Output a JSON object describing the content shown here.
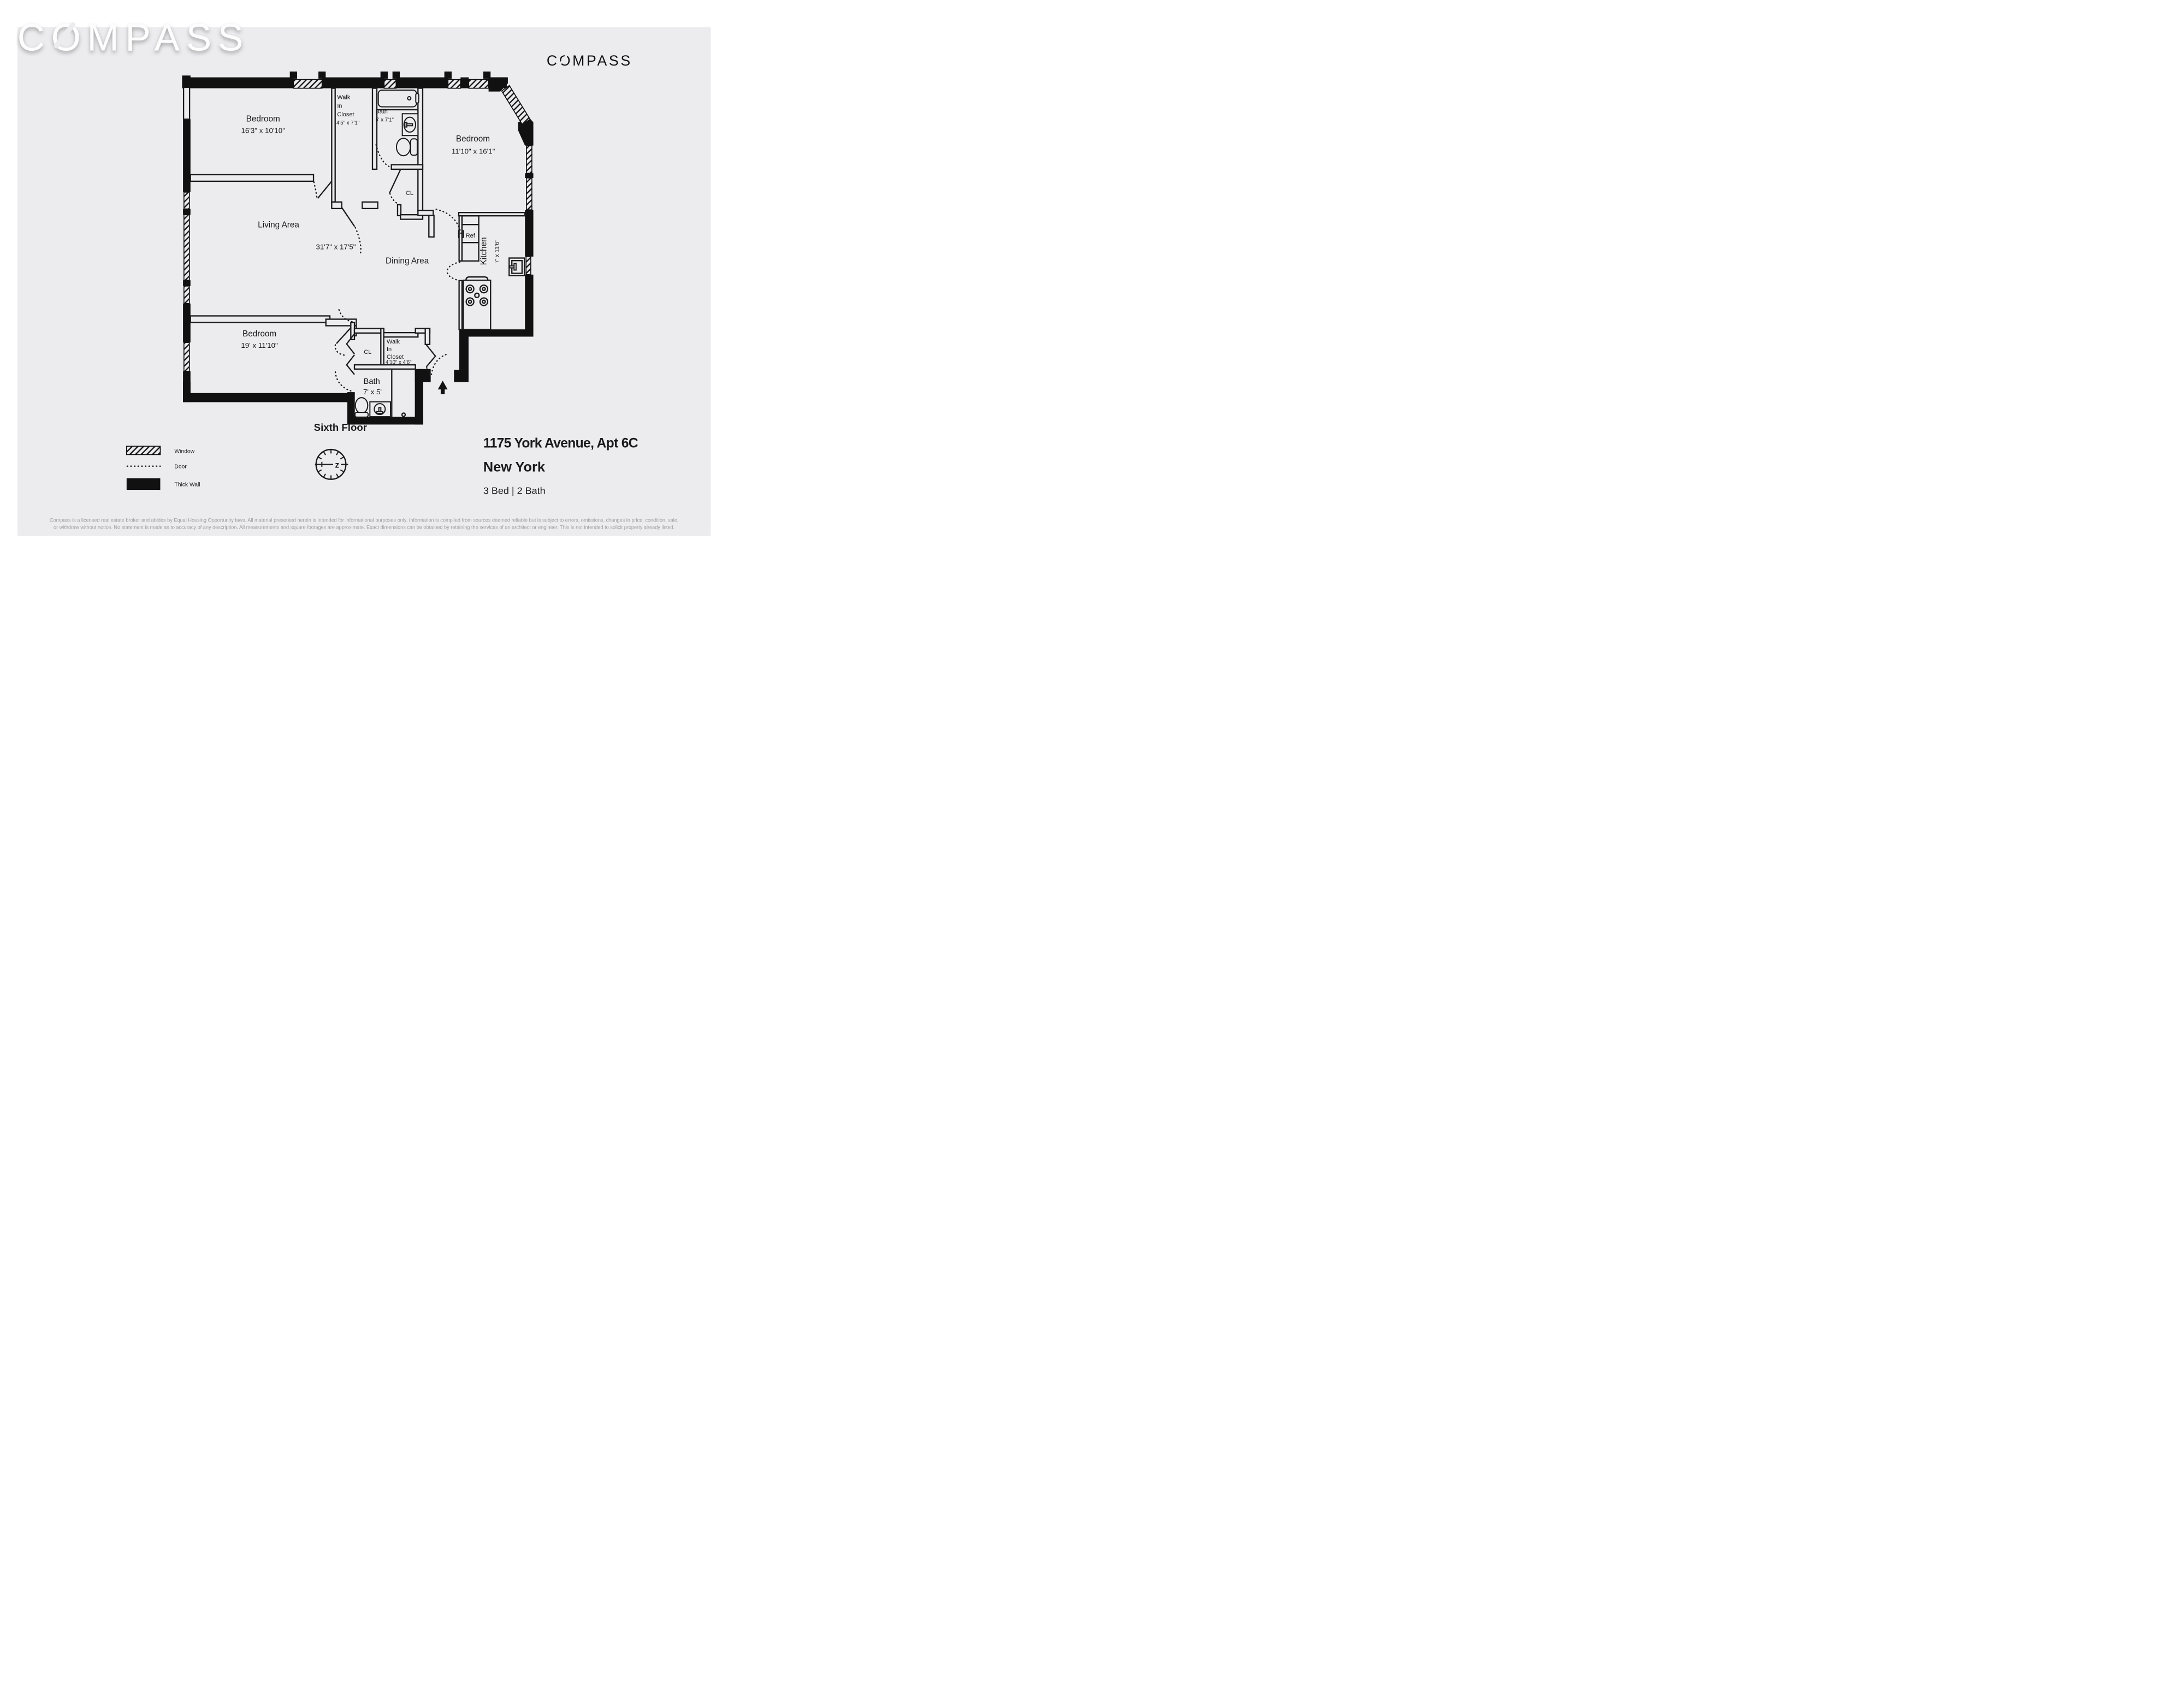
{
  "branding": {
    "watermark": "COMPASS",
    "logo": "COMPASS"
  },
  "plan": {
    "rooms": {
      "bedroom_top_left": {
        "name": "Bedroom",
        "dims": "16'3\" x 10'10\""
      },
      "walk_in_closet_top": {
        "line1": "Walk",
        "line2": "In",
        "line3": "Closet",
        "dims": "4'5\" x 7'1\""
      },
      "bath_top": {
        "name": "Bath",
        "dims": "5' x 7'1\""
      },
      "closet_top": {
        "name": "CL"
      },
      "bedroom_top_right": {
        "name": "Bedroom",
        "dims": "11'10\" x 16'1\""
      },
      "living": {
        "name": "Living Area",
        "dims": "31'7\" x 17'5\""
      },
      "dining": {
        "name": "Dining Area"
      },
      "kitchen": {
        "name": "Kitchen",
        "dims": "7' x 11'6\"",
        "fridge": "Ref"
      },
      "bedroom_bottom": {
        "name": "Bedroom",
        "dims": "19' x 11'10\""
      },
      "closet_bottom": {
        "name": "CL"
      },
      "walk_in_closet_bottom": {
        "line1": "Walk",
        "line2": "In",
        "line3": "Closet",
        "dims": "4'10\" x 4'6\""
      },
      "bath_bottom": {
        "name": "Bath",
        "dims": "7' x 5'"
      }
    },
    "floor_label": "Sixth Floor",
    "compass_letter": "z"
  },
  "legend": {
    "window": "Window",
    "door": "Door",
    "thick_wall": "Thick Wall"
  },
  "listing": {
    "address": "1175 York Avenue, Apt 6C",
    "city": "New York",
    "beds_baths": "3 Bed | 2 Bath"
  },
  "disclaimer": {
    "line1": "Compass is a licensed real estate broker and abides by Equal Housing Opportunity laws. All material presented herein is intended for informational purposes only. Information is compiled from sources deemed reliable but is subject to errors, omissions, changes in price, condition, sale,",
    "line2": "or withdraw without notice. No statement is made as to accuracy of any description. All measurements and square footages are approximate. Exact dimensions can be obtained by retaining the services of an architect or engineer. This is not intended to solicit property already listed."
  },
  "colors": {
    "background": "#ececee",
    "wall": "#111111",
    "text": "#1a1a1a",
    "muted": "#9b9ba1"
  }
}
